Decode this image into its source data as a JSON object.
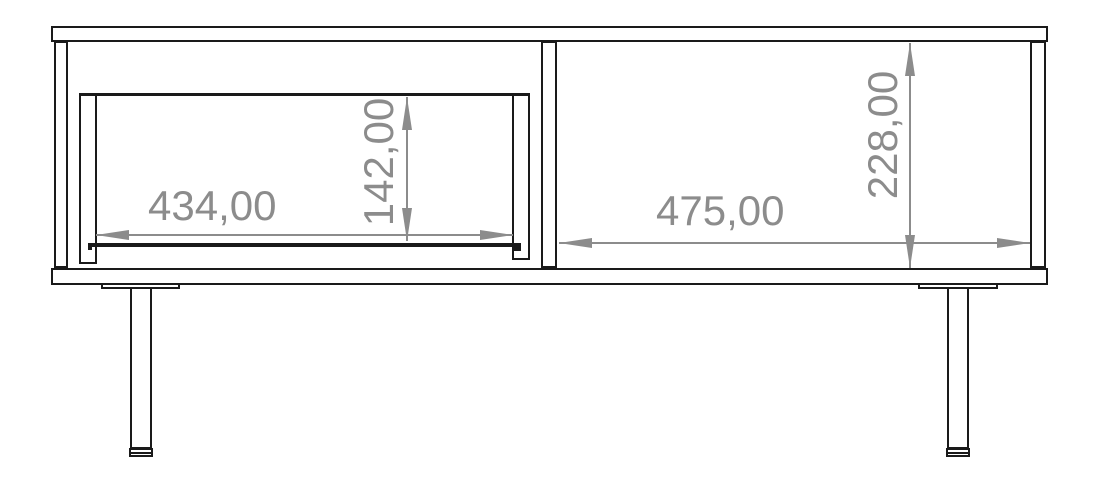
{
  "drawing": {
    "type": "furniture-front-view-technical-drawing",
    "colors": {
      "outline": "#1a1a1a",
      "dimension": "#8c8c8c",
      "background": "#ffffff"
    },
    "dimensions": {
      "drawer_opening_width": {
        "value": "434,00",
        "orientation": "horizontal"
      },
      "drawer_opening_height": {
        "value": "142,00",
        "orientation": "vertical"
      },
      "right_compartment_width": {
        "value": "475,00",
        "orientation": "horizontal"
      },
      "interior_height": {
        "value": "228,00",
        "orientation": "vertical"
      }
    }
  }
}
